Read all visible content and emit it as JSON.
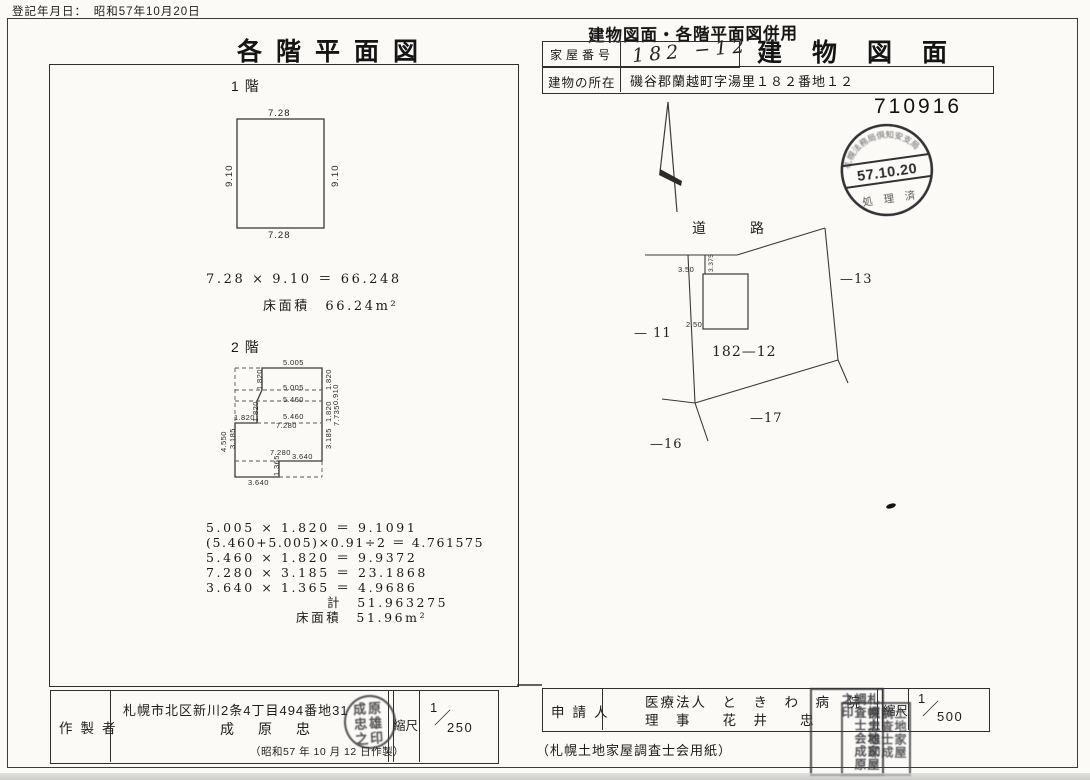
{
  "page": {
    "registration_line": "登記年月日：　昭和57年10月20日",
    "certificate_number": "710916",
    "paper_note": "（札幌土地家屋調査士会用紙）"
  },
  "titles": {
    "left": "各階平面図",
    "right": "建物図面",
    "combined_stamp": "建物図面・各階平面図併用"
  },
  "header": {
    "house_number_label": "家屋番号",
    "house_number_value": "182 −12",
    "location_label": "建物の所在",
    "location_value": "磯谷郡蘭越町字湯里１８２番地１２"
  },
  "receipt_stamp": {
    "arc_text": "札幌法務局倶知安支局",
    "date": "57.10.20",
    "bottom_text": "処 理 済"
  },
  "floor1": {
    "label": "1階",
    "dims": {
      "top": "7.28",
      "bottom": "7.28",
      "left": "9.10",
      "right": "9.10"
    },
    "calc_line": "7.28 × 9.10 ＝ 66.248",
    "area_line": "床面積　66.24m²"
  },
  "floor2": {
    "label": "2階",
    "dims": {
      "top_width": "5.005",
      "mid_5005": "5.005",
      "mid_5460a": "5.460",
      "mid_5460b": "5.460",
      "mid_7280a": "7.280",
      "mid_7280b": "7.280",
      "bottom_right": "3.640",
      "bottom_left": "3.640",
      "left_step": "1.820",
      "left_band1": "1.820",
      "left_inner": "1.820",
      "left_3185": "3.185",
      "left_total": "4.550",
      "right_1": "1.820",
      "right_2": "0.910",
      "right_3": "1.820",
      "right_total": "7.735",
      "right_4": "3.185",
      "step_height": "1.365"
    },
    "calc_lines": [
      "5.005 × 1.820 ＝ 9.1091",
      "(5.460+5.005)×0.91÷2 ＝ 4.761575",
      "5.460 × 1.820 ＝ 9.9372",
      "7.280 × 3.185 ＝ 23.1868",
      "3.640 × 1.365 ＝ 4.9686"
    ],
    "total_line": "計　51.963275",
    "area_line": "床面積　51.96m²"
  },
  "site": {
    "road_label": "道路",
    "parcels": {
      "p13": "—13",
      "p11": "— 11",
      "main": "182—12",
      "p17": "—17",
      "p16": "—16"
    },
    "dims": {
      "road_offset": "3.375",
      "top": "3.50",
      "left": "2.50"
    }
  },
  "maker": {
    "label": "作製者",
    "address": "札幌市北区新川2条4丁目494番地31",
    "name": "成原忠",
    "date_note": "（昭和57 年 10 月 12 日作製）",
    "scale_label": "縮尺",
    "scale_num": "1",
    "scale_den": "250"
  },
  "applicant": {
    "label": "申請人",
    "line1": "医療法人　と　き　わ　病　院",
    "line2": "理　事　　花　井　　忠",
    "scale_label": "縮尺",
    "scale_num": "1",
    "scale_den": "500"
  },
  "seals": {
    "creator_seal": "成原忠雄之印",
    "square_seal_a": "札幌土地家屋調査士会成原之印",
    "square_seal_b": "土地家屋調査士成原忠雄印"
  }
}
